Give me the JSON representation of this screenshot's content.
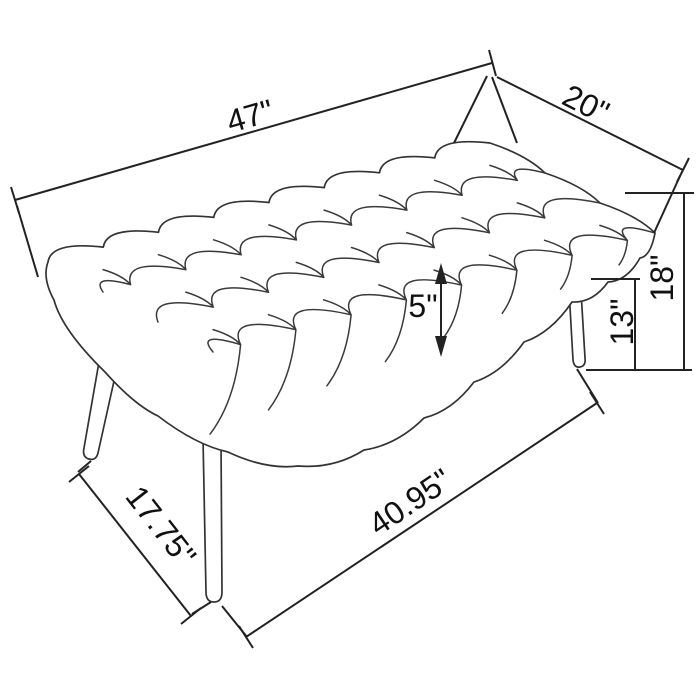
{
  "diagram": {
    "subject": "upholstered tufted bench - dimension line drawing",
    "colors": {
      "line": "#222222",
      "sketch": "#3a3a3a",
      "background": "#ffffff"
    },
    "dimensions": {
      "top_length": "47\"",
      "top_depth": "20\"",
      "overall_height": "18\"",
      "leg_height": "13\"",
      "cushion_thickness": "5\"",
      "leg_span_depth": "17.75\"",
      "leg_span_length": "40.95\""
    }
  }
}
